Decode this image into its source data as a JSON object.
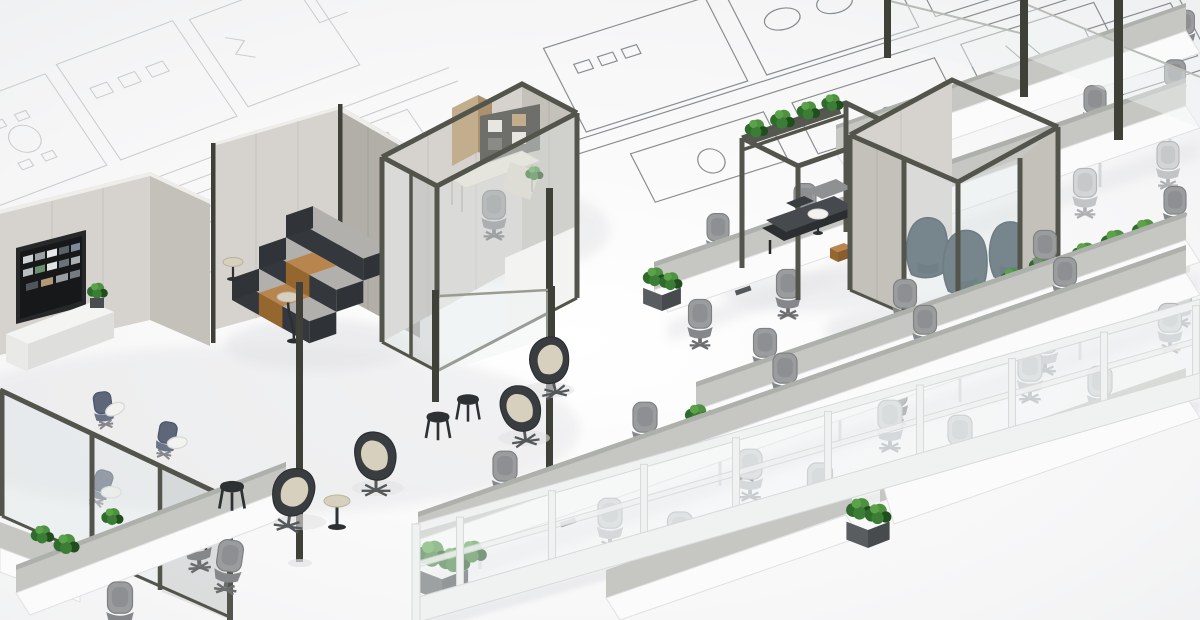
{
  "scene": {
    "title": "3D isometric rendering of a modern open-plan office interior over architectural blueprint floor plans",
    "caption": "Rendered office concept: enclosed meeting pods and private office with olive-framed glass walls, tiered seating with wood steps, lounge with egg chairs and stools, rows of white bench workstations with gray privacy screens, greenery planters, and a white-framed glass partition, all placed on a white floor printed with blueprint line drawings.",
    "style": "photorealistic 3d render, white background",
    "no_visible_text": true
  },
  "palette": {
    "bg": "#fdfdfe",
    "floor": "#f5f5f6",
    "blueprintLight": "#c3c7c9",
    "blueprintDark": "#7d8285",
    "wallTop": "#efedea",
    "wallLight": "#d6d3ce",
    "wallMid": "#c4c1bb",
    "wallDark": "#b2afa9",
    "frameDark": "#53554c",
    "frameDarker": "#3f4139",
    "glassTint": "#dfe6e6",
    "deskWhite": "#fbfbfc",
    "screenGray": "#c6c7c3",
    "screenGrayDark": "#aeb0ac",
    "cushionGray": "#b2b0ac",
    "charcoal": "#34383c",
    "wood": "#b9854e",
    "woodDark": "#96662f",
    "cream": "#d8d0bf",
    "tealChair": "#2b3e4d",
    "plantGreen": "#3c7d36",
    "plantGreenLight": "#5ba24a",
    "plantGreenDark": "#1f4f1d",
    "shadow": "#e2e3e5",
    "whitePartition": "#f0f1f1"
  },
  "inventory": {
    "rooms": [
      {
        "name": "media-room",
        "contents": [
          "wall display with image mosaic",
          "white credenza",
          "potted plant",
          "3 tablet-arm chairs",
          "glass front with door"
        ]
      },
      {
        "name": "tiered-seating-room",
        "contents": [
          "3-level upholstered tiers",
          "wood stair steps",
          "floor lamp",
          "round side table"
        ]
      },
      {
        "name": "private-office-pod",
        "contents": [
          "L-shaped desk",
          "task chair",
          "wood storage wall",
          "desk plant",
          "glass walls with door"
        ]
      },
      {
        "name": "pergola-lounge",
        "contents": [
          "open frame with planters",
          "daybed with cushions",
          "round side table",
          "wood cube stool"
        ]
      },
      {
        "name": "enclosed-meeting-pod",
        "contents": [
          "3 teal wingback chairs",
          "glass and panel walls",
          "planter bench with greenery"
        ]
      }
    ],
    "open_plan": {
      "workstation_rows": 6,
      "task_chairs_approx": 30,
      "privacy_screens": "light gray fabric",
      "planters_with_greenery_approx": 14,
      "lounge": [
        "4 egg chairs",
        "3 stools",
        "pedestal table"
      ],
      "partitions": [
        "white-framed glass wall bottom right",
        "freestanding glass screens on dark posts"
      ]
    }
  }
}
